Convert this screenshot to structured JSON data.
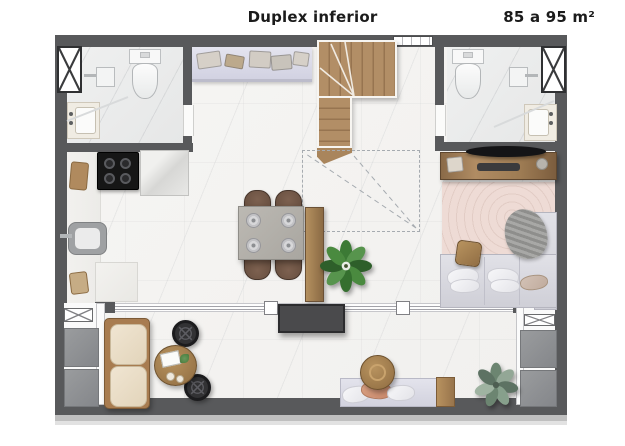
{
  "header": {
    "title": "Duplex inferior",
    "area_label": "85 a 95 m²"
  },
  "palette": {
    "wall": "#58595b",
    "floor": "#f4f3f1",
    "bath_floor": "#ebecec",
    "counter_lavender": "#d2d2e2",
    "wood": "#a9855c",
    "rug_pink": "#eedbd5",
    "sofa_beige": "#e2d4ba",
    "bench_lilac": "#d2d2de",
    "bed_gray": "#cfcfd7",
    "cooktop_black": "#161616",
    "tv_panel": "#4a4a4c",
    "plant_green": "#4a8040",
    "plant_sage": "#7e9183",
    "band_gray": "#bfbfbf"
  },
  "plan": {
    "rooms_depicted": [
      "kitchen",
      "bathroom-left",
      "bathroom-right",
      "living-dining",
      "bedroom",
      "balcony-terrace",
      "staircase"
    ],
    "furniture_icons": [
      "toilet",
      "shower-head",
      "washbasin",
      "shaft-x-box",
      "cooktop",
      "kitchen-sink",
      "counter-appliances",
      "dining-table-4-chairs",
      "plates",
      "sideboard",
      "winder-stairs",
      "stair-projection-dashed",
      "tv-console",
      "wall-tv",
      "bed-sofa",
      "pillows",
      "throw-blanket",
      "area-rug",
      "sofa",
      "lounge-pouf-chairs",
      "round-coffee-table",
      "bench-seat",
      "side-table",
      "potted-plants",
      "sliding-glass-door",
      "ac-utility-panels"
    ]
  }
}
